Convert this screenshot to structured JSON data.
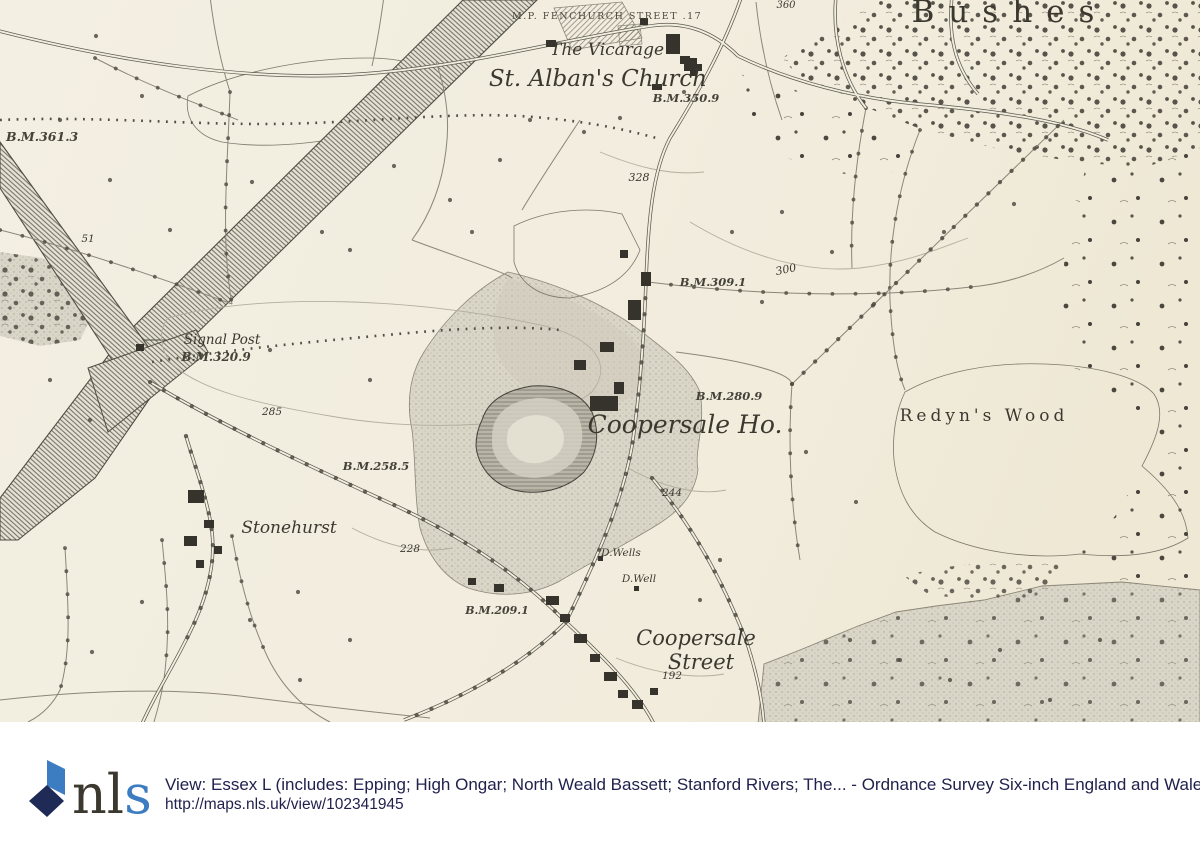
{
  "map": {
    "bg_color": "#f2eede",
    "labels": {
      "fenchurch": "M.P. FENCHURCH STREET .17",
      "vicarage": "The Vicarage",
      "church": "St. Alban's Church",
      "bm_350_9": "B.M.350.9",
      "n360": "360",
      "bushes": "Bushes",
      "bm_361_3": "B.M.361.3",
      "n328": "328",
      "n300": "300",
      "bm_309_1": "B.M.309.1",
      "signal_post": "Signal Post",
      "bm_320_9": "B.M.320.9",
      "n285": "285",
      "bm_280_9": "B.M.280.9",
      "coopersale_ho": "Coopersale Ho.",
      "redyns_wood": "Redyn's Wood",
      "n244": "244",
      "bm_258_5": "B.M.258.5",
      "stonehurst": "Stonehurst",
      "n228": "228",
      "d_wells": "D.Wells",
      "d_well": "D.Well",
      "bm_209_1": "B.M.209.1",
      "coopersale": "Coopersale",
      "street": "Street",
      "n192": "192",
      "n51": "51"
    }
  },
  "footer": {
    "logo": {
      "nl": "nl",
      "s": "s",
      "navy": "#1f2b56",
      "blue": "#3c7cc0"
    },
    "title": "View: Essex L (includes: Epping; High Ongar; North Weald Bassett; Stanford Rivers; The... - Ordnance Survey Six-inch England and Wales",
    "url": "http://maps.nls.uk/view/102341945"
  }
}
